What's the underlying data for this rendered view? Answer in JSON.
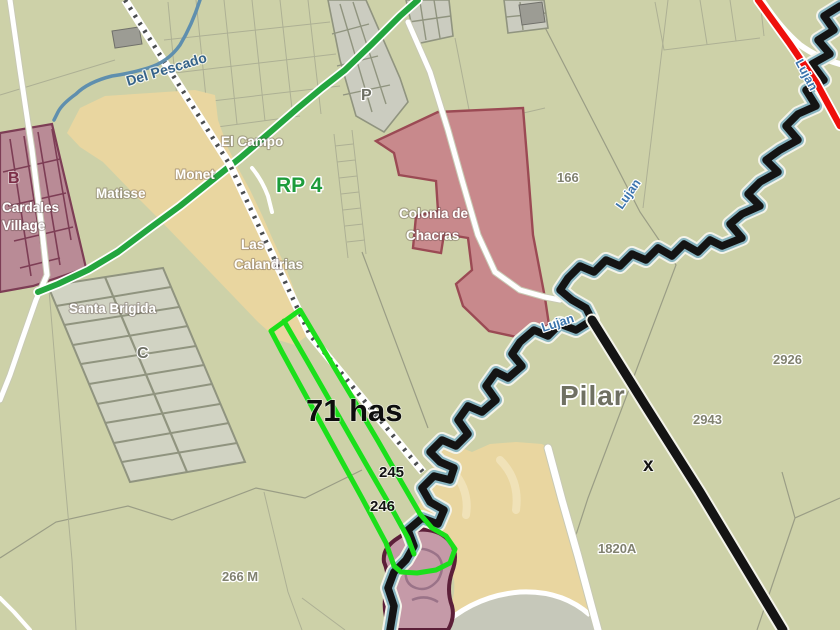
{
  "map": {
    "city_label": "Pilar",
    "highway_label": "RP 4",
    "annotations": {
      "area": "71 has",
      "lot_245": "245",
      "lot_246": "246",
      "marker_x": "x"
    },
    "rivers": {
      "del_pescado": "Del Pescado",
      "lujan_upper": "Lujan",
      "lujan_mid": "Lujan",
      "lujan_right": "Lujan"
    },
    "neighborhoods": {
      "el_campo": "El Campo",
      "monet": "Monet",
      "matisse": "Matisse",
      "cardales_line1": "Cardales",
      "cardales_line2": "Village",
      "santa_brigida": "Santa Brigida",
      "las_calandrias_line1": "Las",
      "las_calandrias_line2": "Calandrias",
      "colonia_line1": "Colonia de",
      "colonia_line2": "Chacras"
    },
    "zone_letters": {
      "b": "B",
      "c": "C",
      "p": "P"
    },
    "parcel_numbers": {
      "n166": "166",
      "n2926": "2926",
      "n2943": "2943",
      "n1820a": "1820A",
      "n266m": "266 M"
    }
  },
  "colors": {
    "background": "#cdd1a8",
    "tan_area": "#e9d6a0",
    "colonia_pink": "#c8898c",
    "colonia_border": "#9b4a54",
    "cardales_mauve": "#b98b96",
    "cardales_border": "#7d3d55",
    "subdivision_gray": "#d1d3c3",
    "street_gray": "#90947f",
    "club_pink": "#c59aa8",
    "club_border": "#5c1f39",
    "property_green": "#1be01b",
    "road_green": "#23a53e",
    "route_red": "#ee100c",
    "route_black": "#141414",
    "river_blue": "#5f8fae",
    "river_teal": "#8ab6c2"
  }
}
